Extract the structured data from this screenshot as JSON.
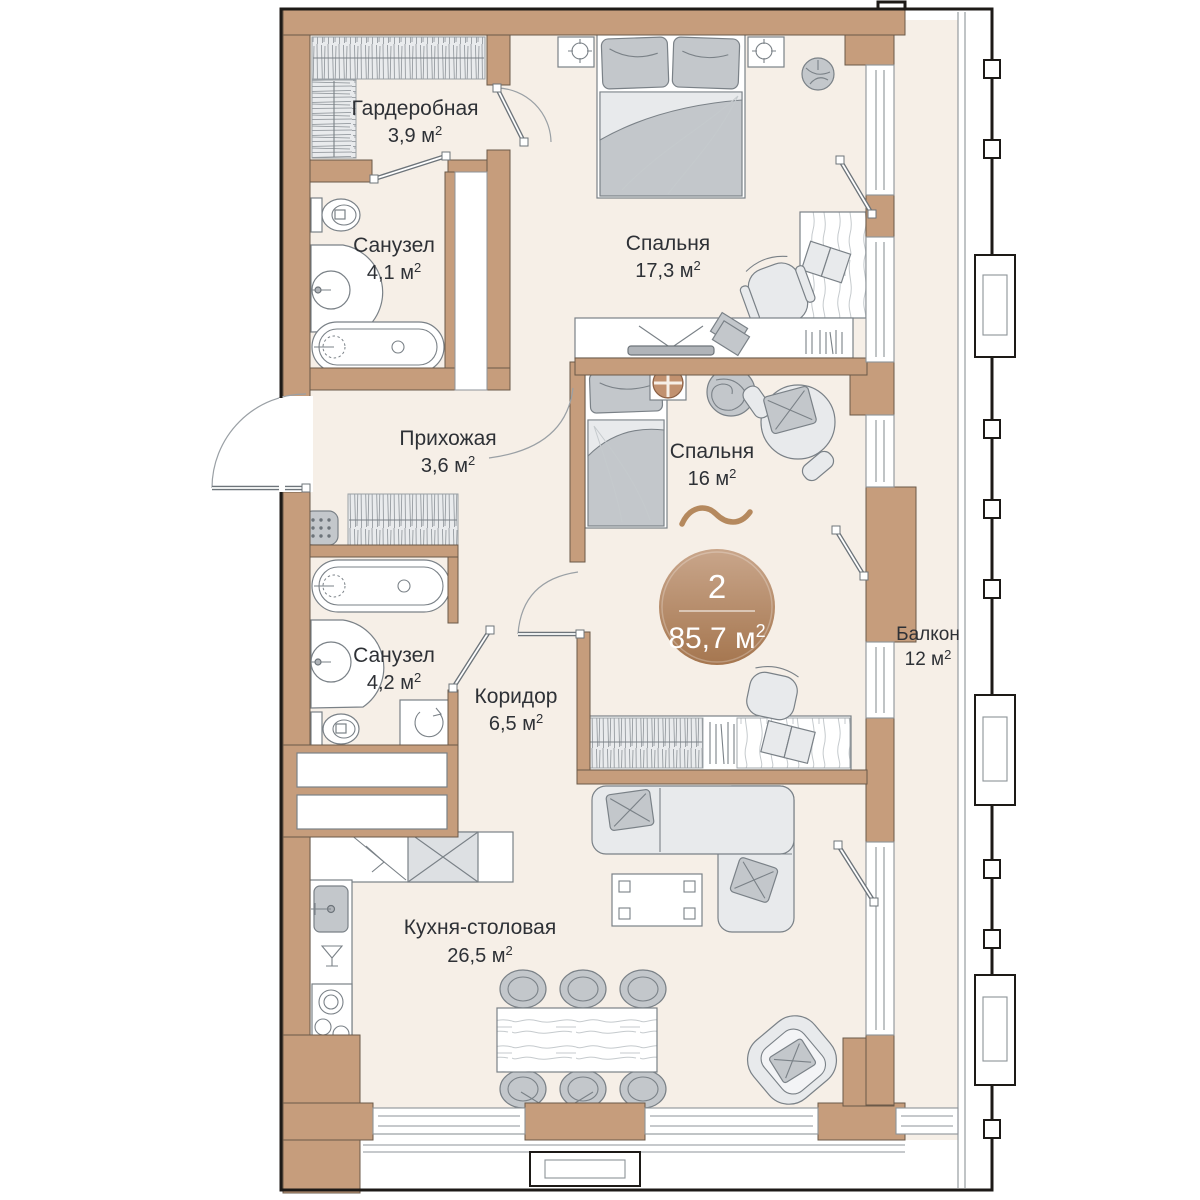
{
  "plan": {
    "rooms_count": "2",
    "total_area": "85,7 м",
    "sup": "2"
  },
  "rooms": [
    {
      "name": "Гардеробная",
      "area": "3,9 м"
    },
    {
      "name": "Санузел",
      "area": "4,1 м"
    },
    {
      "name": "Спальня",
      "area": "17,3 м"
    },
    {
      "name": "Прихожая",
      "area": "3,6 м"
    },
    {
      "name": "Спальня",
      "area": "16 м"
    },
    {
      "name": "Санузел",
      "area": "4,2 м"
    },
    {
      "name": "Коридор",
      "area": "6,5 м"
    },
    {
      "name": "Кухня-столовая",
      "area": "26,5 м"
    },
    {
      "name": "Балкон",
      "area": "12 м"
    }
  ],
  "colors": {
    "wall": "#c69d7c",
    "floor": "#f6efe7",
    "badge_top": "#c9a68b",
    "badge_bottom": "#a5764f",
    "accent": "#b5895e",
    "furniture_gray": "#c3c7cb",
    "outline": "#1d1a17"
  }
}
